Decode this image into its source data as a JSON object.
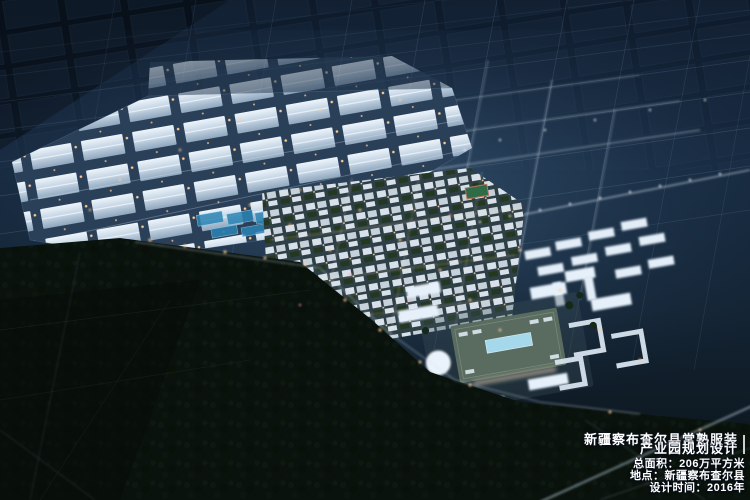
{
  "caption": {
    "title_line1": "新疆察布查尔县常熟服装",
    "title_line2": "产业园规划设计",
    "area": "总面积：206万平方米",
    "location": "地点：新疆察布查尔县",
    "design_time": "设计时间：2016年",
    "text_color": "#ffffff"
  },
  "scene": {
    "type": "aerial-night-planning-rendering",
    "colors": {
      "sky": "#14283d",
      "city_glow": "#55789b",
      "factory_roof": "#d5e2ec",
      "residential": "#d8e1e9",
      "campus_roof": "#5a6c60",
      "forest": "#0a120d",
      "street_light_warm": "#ffcf9a",
      "pond_blue": "#2c84b4"
    }
  }
}
